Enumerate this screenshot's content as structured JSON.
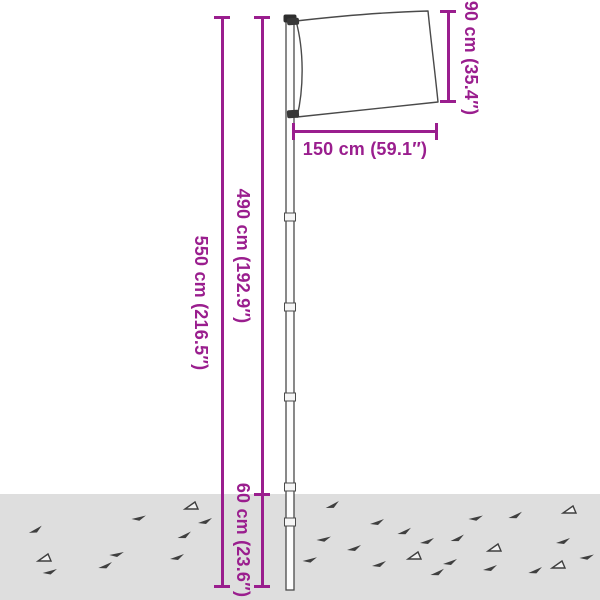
{
  "diagram": {
    "kind": "product dimension diagram",
    "subject": "sectional flagpole with flag set into the ground"
  },
  "measurements": {
    "total_height": "550 cm (216.5″)",
    "pole_above_ground": "490 cm (192.9″)",
    "flag_width": "150 cm (59.1″)",
    "flag_height": "90 cm (35.4″)",
    "in_ground_depth": "60 cm (23.6″)"
  },
  "colors": {
    "measurement": "#9A1E8E",
    "ground": "#DEDEDE",
    "outline": "#4A4A4A"
  },
  "ground": {
    "marks": [
      {
        "x": 28,
        "y": 528,
        "t": "f",
        "r": -10
      },
      {
        "x": 132,
        "y": 514,
        "t": "f",
        "r": 6
      },
      {
        "x": 198,
        "y": 518,
        "t": "f",
        "r": 0
      },
      {
        "x": 177,
        "y": 533,
        "t": "f",
        "r": -6
      },
      {
        "x": 110,
        "y": 550,
        "t": "f",
        "r": 8
      },
      {
        "x": 170,
        "y": 554,
        "t": "f",
        "r": 0
      },
      {
        "x": 98,
        "y": 563,
        "t": "f",
        "r": -4
      },
      {
        "x": 43,
        "y": 568,
        "t": "f",
        "r": 4
      },
      {
        "x": 38,
        "y": 553,
        "t": "o",
        "r": 0
      },
      {
        "x": 185,
        "y": 501,
        "t": "o",
        "r": 0
      },
      {
        "x": 325,
        "y": 503,
        "t": "f",
        "r": -8
      },
      {
        "x": 370,
        "y": 519,
        "t": "f",
        "r": 0
      },
      {
        "x": 397,
        "y": 529,
        "t": "f",
        "r": -5
      },
      {
        "x": 317,
        "y": 535,
        "t": "f",
        "r": 6
      },
      {
        "x": 420,
        "y": 538,
        "t": "f",
        "r": 0
      },
      {
        "x": 450,
        "y": 536,
        "t": "f",
        "r": -6
      },
      {
        "x": 347,
        "y": 545,
        "t": "f",
        "r": 0
      },
      {
        "x": 303,
        "y": 556,
        "t": "f",
        "r": 5
      },
      {
        "x": 372,
        "y": 561,
        "t": "f",
        "r": 0
      },
      {
        "x": 430,
        "y": 570,
        "t": "f",
        "r": -5
      },
      {
        "x": 483,
        "y": 565,
        "t": "f",
        "r": 0
      },
      {
        "x": 563,
        "y": 505,
        "t": "o",
        "r": 0
      },
      {
        "x": 508,
        "y": 513,
        "t": "f",
        "r": -5
      },
      {
        "x": 469,
        "y": 514,
        "t": "f",
        "r": 6
      },
      {
        "x": 556,
        "y": 538,
        "t": "f",
        "r": 0
      },
      {
        "x": 443,
        "y": 559,
        "t": "f",
        "r": 0
      },
      {
        "x": 528,
        "y": 568,
        "t": "f",
        "r": -4
      },
      {
        "x": 488,
        "y": 543,
        "t": "o",
        "r": 0
      },
      {
        "x": 552,
        "y": 560,
        "t": "o",
        "r": 0
      },
      {
        "x": 580,
        "y": 553,
        "t": "f",
        "r": 6
      },
      {
        "x": 408,
        "y": 551,
        "t": "o",
        "r": 0
      }
    ]
  }
}
